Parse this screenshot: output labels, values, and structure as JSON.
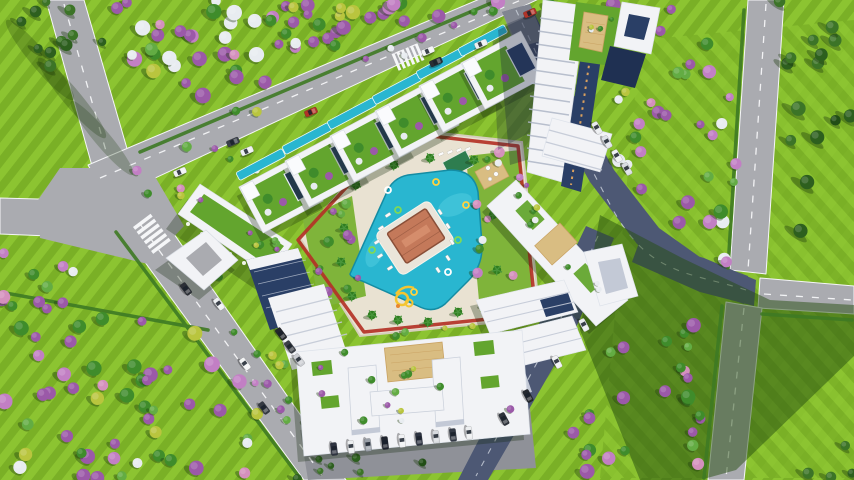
{
  "scene": {
    "kind": "aerial-architectural-render",
    "description": "Bird's-eye 3D render of a triangular residential development: central turquoise lagoon pool with clubhouse island, red running-track loop, rooftop-garden villas, white apartment towers, surrounding roads, lawns and flowering trees.",
    "elements": [
      "lawn",
      "flowering-tree-fields",
      "conifer-groves",
      "road-network",
      "triangular-site",
      "red-running-track",
      "central-pool",
      "clubhouse-island",
      "water-slide",
      "villas-with-lap-pools",
      "main-tower",
      "apartment-blocks",
      "entrance-gate",
      "parked-cars"
    ]
  },
  "palette": {
    "lawn": "#8cc431",
    "lawnStripe": "#7ab026",
    "shadowGreen": "#27500f",
    "roadLight": "#aaabb0",
    "roadMid": "#8f9198",
    "roadDark": "#4d5874",
    "roadLine": "#f5f6f8",
    "hedge": "#3e7a24",
    "deck": "#e9e2d2",
    "deckShade": "#d6cebc",
    "pool": "#29b6d0",
    "poolLight": "#54cde0",
    "poolDark": "#148ca3",
    "track": "#b33226",
    "white": "#f2f3f6",
    "whiteShade": "#c3c9d6",
    "navy": "#2a3f66",
    "navyDark": "#1f3052",
    "greenRoof": "#63a52e",
    "gardenLawn": "#7fb43a",
    "tan": "#d9bd82",
    "tanLine": "#c9a262",
    "clubRoof": "#c4795a",
    "clubRoofDark": "#8a4f38",
    "clubRoofLight": "#d89070",
    "slide": "#f4c531",
    "slideAccent": "#e8862f",
    "treePurple": "#9b59a8",
    "treePurpleLt": "#c27fc4",
    "treePink": "#d490bd",
    "treeGreen": "#3f8c2b",
    "treeGreenLt": "#63ac43",
    "treeWhite": "#e8ecf0",
    "treeYellow": "#b9c53e",
    "conifer": "#2d5f1e",
    "coniferLt": "#3c7427",
    "coniferDk": "#224e16",
    "palm": "#2f7d1f"
  },
  "trees": {
    "regions": [
      {
        "name": "topleft-conifers",
        "layer": "ground",
        "kind": "conifer",
        "seed": 11,
        "count": 11,
        "rmin": 4,
        "rmax": 6.5,
        "poly": [
          [
            0,
            0
          ],
          [
            120,
            0
          ],
          [
            98,
            60
          ],
          [
            8,
            78
          ]
        ]
      },
      {
        "name": "top-flower-field",
        "layer": "ground",
        "kind": "flower",
        "seed": 21,
        "count": 58,
        "rmin": 4.5,
        "rmax": 8,
        "poly": [
          [
            116,
            0
          ],
          [
            536,
            0
          ],
          [
            352,
            46
          ],
          [
            208,
            106
          ],
          [
            112,
            50
          ]
        ]
      },
      {
        "name": "right-flower-strip",
        "layer": "ground",
        "kind": "flower",
        "seed": 31,
        "count": 40,
        "rmin": 4,
        "rmax": 7.5,
        "poly": [
          [
            538,
            0
          ],
          [
            748,
            0
          ],
          [
            734,
            266
          ],
          [
            664,
            232
          ],
          [
            606,
            158
          ],
          [
            560,
            60
          ]
        ]
      },
      {
        "name": "lower-right-flower-strip",
        "layer": "ground",
        "kind": "flower",
        "seed": 41,
        "count": 26,
        "rmin": 4,
        "rmax": 7.5,
        "poly": [
          [
            600,
            345
          ],
          [
            704,
            318
          ],
          [
            714,
            478
          ],
          [
            540,
            478
          ]
        ]
      },
      {
        "name": "bottomleft-flower-field",
        "layer": "ground",
        "kind": "flower",
        "seed": 51,
        "count": 55,
        "rmin": 4.5,
        "rmax": 8,
        "poly": [
          [
            0,
            288
          ],
          [
            212,
            326
          ],
          [
            266,
            424
          ],
          [
            252,
            480
          ],
          [
            0,
            480
          ]
        ]
      },
      {
        "name": "leftmid-scatter",
        "layer": "ground",
        "kind": "flower",
        "seed": 61,
        "count": 5,
        "rmin": 3.5,
        "rmax": 6,
        "poly": [
          [
            4,
            240
          ],
          [
            86,
            252
          ],
          [
            64,
            306
          ],
          [
            0,
            302
          ]
        ]
      },
      {
        "name": "topright-conifers",
        "layer": "ground",
        "kind": "conifer",
        "seed": 71,
        "count": 15,
        "rmin": 5,
        "rmax": 7.5,
        "poly": [
          [
            774,
            0
          ],
          [
            854,
            0
          ],
          [
            854,
            252
          ],
          [
            792,
            242
          ]
        ]
      },
      {
        "name": "bottomright-conifers",
        "layer": "ground",
        "kind": "conifer",
        "seed": 81,
        "count": 4,
        "rmin": 4,
        "rmax": 6,
        "poly": [
          [
            812,
            440
          ],
          [
            854,
            430
          ],
          [
            854,
            480
          ],
          [
            800,
            480
          ]
        ]
      },
      {
        "name": "top-road-verge",
        "layer": "ground",
        "kind": "flower",
        "seed": 91,
        "count": 12,
        "rmin": 3,
        "rmax": 5,
        "poly": [
          [
            150,
            146
          ],
          [
            520,
            -8
          ],
          [
            536,
            2
          ],
          [
            166,
            158
          ]
        ]
      },
      {
        "name": "villa-verge",
        "layer": "ground",
        "kind": "flower",
        "seed": 101,
        "count": 8,
        "rmin": 3,
        "rmax": 5,
        "poly": [
          [
            130,
            170
          ],
          [
            240,
            140
          ],
          [
            262,
            168
          ],
          [
            160,
            210
          ]
        ]
      },
      {
        "name": "down-road-verge",
        "layer": "ground",
        "kind": "flower",
        "seed": 111,
        "count": 7,
        "rmin": 3,
        "rmax": 4.5,
        "poly": [
          [
            195,
            262
          ],
          [
            215,
            258
          ],
          [
            290,
            420
          ],
          [
            268,
            428
          ]
        ]
      },
      {
        "name": "bottom-palm-row",
        "layer": "ground",
        "kind": "conifer",
        "seed": 121,
        "count": 7,
        "rmin": 3,
        "rmax": 5,
        "poly": [
          [
            292,
            456
          ],
          [
            424,
            446
          ],
          [
            428,
            480
          ],
          [
            292,
            480
          ]
        ]
      },
      {
        "name": "site-left-garden",
        "layer": "site",
        "kind": "roofgarden",
        "seed": 131,
        "count": 13,
        "rmin": 3,
        "rmax": 5.5,
        "poly": [
          [
            303,
            220
          ],
          [
            352,
            196
          ],
          [
            366,
            296
          ],
          [
            320,
            308
          ]
        ]
      },
      {
        "name": "site-right-garden",
        "layer": "site",
        "kind": "pink",
        "seed": 141,
        "count": 15,
        "rmin": 3,
        "rmax": 5.5,
        "poly": [
          [
            466,
            156
          ],
          [
            520,
            150
          ],
          [
            534,
            306
          ],
          [
            480,
            312
          ]
        ]
      },
      {
        "name": "site-bottom-strip",
        "layer": "site",
        "kind": "roofgarden",
        "seed": 151,
        "count": 6,
        "rmin": 2.5,
        "rmax": 4,
        "poly": [
          [
            364,
            334
          ],
          [
            530,
            318
          ],
          [
            534,
            336
          ],
          [
            368,
            352
          ]
        ]
      },
      {
        "name": "site-sw-corner",
        "layer": "site",
        "kind": "roofgarden",
        "seed": 161,
        "count": 6,
        "rmin": 3,
        "rmax": 4.5,
        "poly": [
          [
            270,
            350
          ],
          [
            300,
            340
          ],
          [
            320,
            420
          ],
          [
            290,
            440
          ]
        ]
      },
      {
        "name": "roof-left-arcade",
        "layer": "roof",
        "kind": "roofgarden",
        "seed": 171,
        "count": 7,
        "rmin": 2.5,
        "rmax": 4,
        "poly": [
          [
            192,
            206
          ],
          [
            208,
            190
          ],
          [
            284,
            244
          ],
          [
            266,
            268
          ]
        ]
      },
      {
        "name": "roof-bottom-lowrise",
        "layer": "roof",
        "kind": "roofgarden",
        "seed": 181,
        "count": 14,
        "rmin": 2.5,
        "rmax": 4,
        "poly": [
          [
            314,
            350
          ],
          [
            514,
            332
          ],
          [
            518,
            424
          ],
          [
            318,
            442
          ]
        ]
      },
      {
        "name": "roof-right-building",
        "layer": "roof",
        "kind": "roofgarden",
        "seed": 191,
        "count": 9,
        "rmin": 2,
        "rmax": 3.5,
        "poly": [
          [
            500,
            196
          ],
          [
            524,
            180
          ],
          [
            620,
            292
          ],
          [
            596,
            316
          ]
        ]
      },
      {
        "name": "tower-roof-garden",
        "layer": "roof",
        "kind": "roofgarden",
        "seed": 201,
        "count": 4,
        "rmin": 2,
        "rmax": 3,
        "poly": [
          [
            578,
            6
          ],
          [
            616,
            10
          ],
          [
            608,
            62
          ],
          [
            572,
            56
          ]
        ]
      }
    ]
  },
  "villas": {
    "angle": -28,
    "centers": [
      [
        281,
        194
      ],
      [
        327,
        168
      ],
      [
        372,
        143
      ],
      [
        417,
        118
      ],
      [
        461,
        93
      ],
      [
        503,
        70
      ]
    ]
  },
  "cars": [
    {
      "x": 530,
      "y": 13,
      "a": -23,
      "c": "#b03328"
    },
    {
      "x": 481,
      "y": 44,
      "a": -23,
      "c": "#eceef0"
    },
    {
      "x": 428,
      "y": 51,
      "a": -23,
      "c": "#f2f3f5"
    },
    {
      "x": 436,
      "y": 62,
      "a": -23,
      "c": "#2a2e35"
    },
    {
      "x": 311,
      "y": 112,
      "a": -23,
      "c": "#b03328"
    },
    {
      "x": 247,
      "y": 151,
      "a": -23,
      "c": "#eef0f2"
    },
    {
      "x": 233,
      "y": 142,
      "a": -23,
      "c": "#3a4049"
    },
    {
      "x": 180,
      "y": 172,
      "a": -23,
      "c": "#f0f1f3"
    },
    {
      "x": 186,
      "y": 289,
      "a": 53,
      "c": "#2b2f36"
    },
    {
      "x": 219,
      "y": 304,
      "a": 53,
      "c": "#eef0f2"
    },
    {
      "x": 245,
      "y": 364,
      "a": 53,
      "c": "#f2f3f4"
    },
    {
      "x": 264,
      "y": 408,
      "a": 53,
      "c": "#343942"
    },
    {
      "x": 597,
      "y": 128,
      "a": 60,
      "c": "#e9ebee"
    },
    {
      "x": 607,
      "y": 142,
      "a": 60,
      "c": "#dfe3e8"
    },
    {
      "x": 617,
      "y": 156,
      "a": 60,
      "c": "#f0f2f4"
    },
    {
      "x": 627,
      "y": 169,
      "a": 60,
      "c": "#d9dce1"
    },
    {
      "x": 584,
      "y": 325,
      "a": 62,
      "c": "#eaecef"
    },
    {
      "x": 557,
      "y": 362,
      "a": 62,
      "c": "#f1f2f4"
    },
    {
      "x": 528,
      "y": 396,
      "a": 62,
      "c": "#24282e"
    },
    {
      "x": 504,
      "y": 419,
      "a": 62,
      "c": "#2e333b"
    },
    {
      "x": 281,
      "y": 334,
      "a": 53,
      "c": "#23262c"
    },
    {
      "x": 290,
      "y": 347,
      "a": 53,
      "c": "#3b3f47"
    },
    {
      "x": 299,
      "y": 360,
      "a": 53,
      "c": "#caccd1"
    },
    {
      "x": 334,
      "y": 449,
      "a": 83,
      "c": "#2e3340"
    },
    {
      "x": 351,
      "y": 447,
      "a": 83,
      "c": "#eceef0"
    },
    {
      "x": 368,
      "y": 445,
      "a": 83,
      "c": "#9aa0a8"
    },
    {
      "x": 385,
      "y": 443,
      "a": 83,
      "c": "#20242e"
    },
    {
      "x": 402,
      "y": 441,
      "a": 83,
      "c": "#f0f1f3"
    },
    {
      "x": 419,
      "y": 439,
      "a": 83,
      "c": "#2c3240"
    },
    {
      "x": 436,
      "y": 437,
      "a": 83,
      "c": "#d7dade"
    },
    {
      "x": 453,
      "y": 435,
      "a": 83,
      "c": "#343a46"
    },
    {
      "x": 469,
      "y": 433,
      "a": 83,
      "c": "#eceef0"
    }
  ],
  "palms": [
    [
      356,
      185
    ],
    [
      344,
      228
    ],
    [
      341,
      262
    ],
    [
      352,
      296
    ],
    [
      372,
      315
    ],
    [
      398,
      320
    ],
    [
      428,
      322
    ],
    [
      458,
      312
    ],
    [
      486,
      305
    ],
    [
      497,
      270
    ],
    [
      493,
      215
    ],
    [
      474,
      160
    ],
    [
      430,
      158
    ],
    [
      394,
      165
    ]
  ],
  "floats": [
    {
      "x": 388,
      "y": 190,
      "c": "#ffffff"
    },
    {
      "x": 436,
      "y": 182,
      "c": "#ffd23f"
    },
    {
      "x": 458,
      "y": 240,
      "c": "#7ed957"
    },
    {
      "x": 448,
      "y": 272,
      "c": "#ffffff"
    },
    {
      "x": 414,
      "y": 292,
      "c": "#ffd23f"
    },
    {
      "x": 372,
      "y": 250,
      "c": "#7ed957"
    },
    {
      "x": 398,
      "y": 210,
      "c": "#7ed957"
    },
    {
      "x": 466,
      "y": 205,
      "c": "#ffd23f"
    }
  ],
  "loungers": [
    {
      "x": 388,
      "y": 215,
      "a": -33
    },
    {
      "x": 381,
      "y": 228,
      "a": -33
    },
    {
      "x": 377,
      "y": 242,
      "a": -33
    },
    {
      "x": 380,
      "y": 256,
      "a": -33
    },
    {
      "x": 390,
      "y": 268,
      "a": -33
    },
    {
      "x": 440,
      "y": 212,
      "a": 57
    },
    {
      "x": 448,
      "y": 226,
      "a": 57
    },
    {
      "x": 452,
      "y": 242,
      "a": 57
    },
    {
      "x": 448,
      "y": 258,
      "a": 57
    },
    {
      "x": 438,
      "y": 270,
      "a": 57
    },
    {
      "x": 432,
      "y": 156,
      "a": -23
    },
    {
      "x": 441,
      "y": 154,
      "a": -23
    },
    {
      "x": 450,
      "y": 152,
      "a": -23
    },
    {
      "x": 459,
      "y": 150,
      "a": -23
    },
    {
      "x": 468,
      "y": 149,
      "a": -23
    }
  ],
  "treeKinds": {
    "flower": [
      [
        "treePurple",
        0.32
      ],
      [
        "treePurpleLt",
        0.12
      ],
      [
        "treeGreen",
        0.22
      ],
      [
        "treeGreenLt",
        0.08
      ],
      [
        "treeWhite",
        0.12
      ],
      [
        "treeYellow",
        0.08
      ],
      [
        "treePink",
        0.06
      ]
    ],
    "conifer": [
      [
        "conifer",
        0.55
      ],
      [
        "coniferLt",
        0.3
      ],
      [
        "coniferDk",
        0.15
      ]
    ],
    "roofgarden": [
      [
        "treeGreen",
        0.35
      ],
      [
        "treeGreenLt",
        0.2
      ],
      [
        "treePurple",
        0.2
      ],
      [
        "treeWhite",
        0.12
      ],
      [
        "treeYellow",
        0.13
      ]
    ],
    "pink": [
      [
        "treePink",
        0.34
      ],
      [
        "treePurpleLt",
        0.24
      ],
      [
        "treeGreen",
        0.2
      ],
      [
        "treeWhite",
        0.12
      ],
      [
        "treeYellow",
        0.1
      ]
    ]
  }
}
